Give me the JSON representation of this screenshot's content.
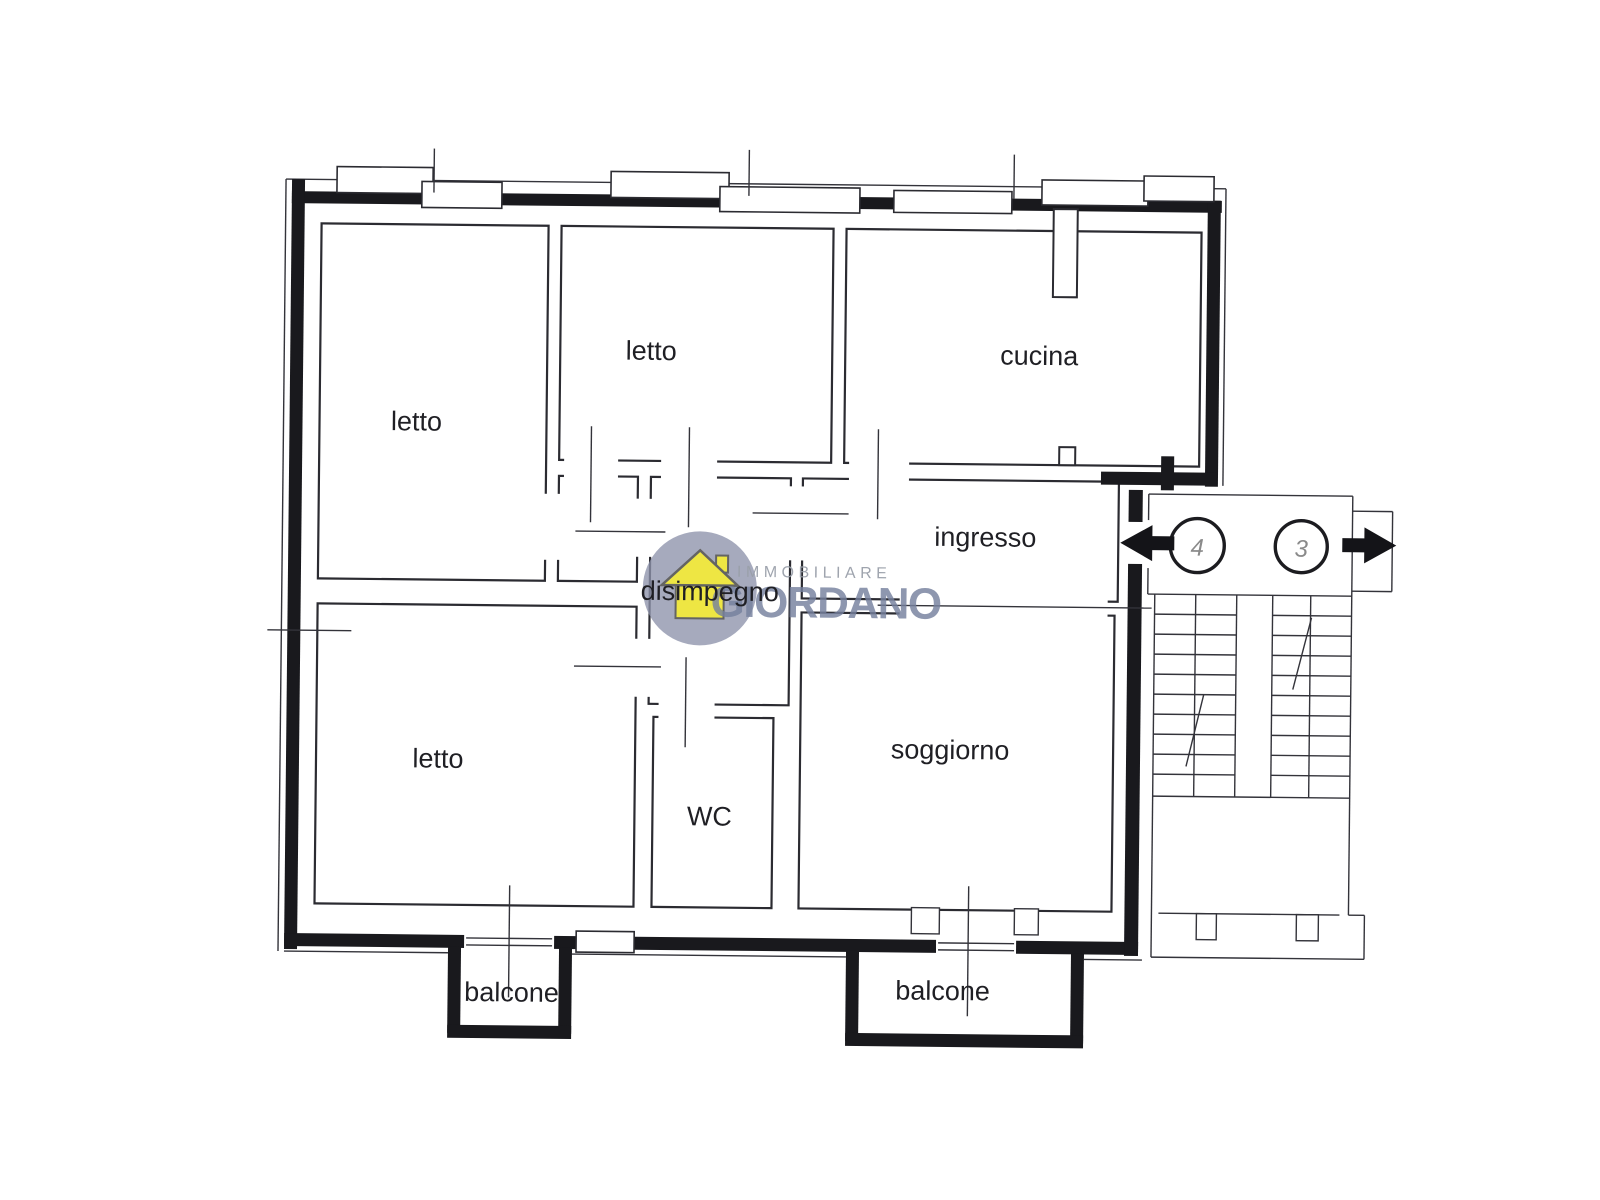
{
  "plan": {
    "rooms": [
      {
        "id": "letto-top-left",
        "label": "letto"
      },
      {
        "id": "letto-top-middle",
        "label": "letto"
      },
      {
        "id": "cucina",
        "label": "cucina"
      },
      {
        "id": "ingresso",
        "label": "ingresso"
      },
      {
        "id": "disimpegno",
        "label": "disimpegno"
      },
      {
        "id": "letto-bottom-left",
        "label": "letto"
      },
      {
        "id": "wc",
        "label": "WC"
      },
      {
        "id": "soggiorno",
        "label": "soggiorno"
      },
      {
        "id": "balcone-left",
        "label": "balcone"
      },
      {
        "id": "balcone-right",
        "label": "balcone"
      }
    ],
    "stairwell": {
      "apartment_numbers": [
        "4",
        "3"
      ]
    },
    "ink_color": "#2b2b31",
    "thick_wall_color": "#19191d"
  },
  "watermark": {
    "line1": "IMMOBILIARE",
    "line2": "GIORDANO",
    "circle_color": "#8d92ab",
    "house_color": "#f2ea3d",
    "line1_color": "#9aa0aa",
    "line2_color": "#76819e"
  }
}
